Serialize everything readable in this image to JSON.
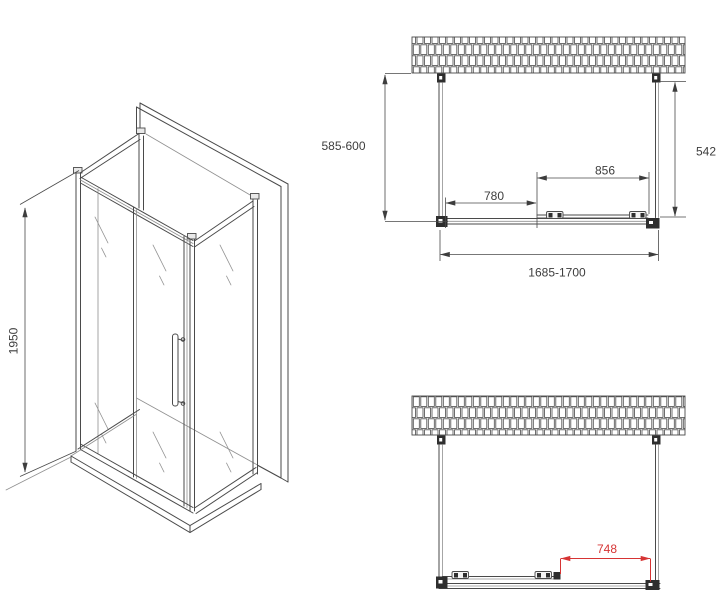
{
  "document": {
    "kind": "shower-enclosure-technical-drawing",
    "views": [
      "isometric-view",
      "plan-view-top",
      "plan-view-bottom"
    ]
  },
  "colors": {
    "background": "#ffffff",
    "line": "#4a4a4a",
    "light_line": "#909090",
    "fill_dark": "#2e2e2e",
    "dimension_text": "#3d3d3d",
    "accent_red": "#d63434"
  },
  "isometric_view": {
    "height_dimension": "1950"
  },
  "plan_view_top": {
    "left_side_depth": "585-600",
    "right_side_depth": "542",
    "fixed_panel_width": "780",
    "sliding_door_width": "856",
    "overall_width": "1685-1700"
  },
  "plan_view_bottom": {
    "door_opening_width": "748"
  }
}
